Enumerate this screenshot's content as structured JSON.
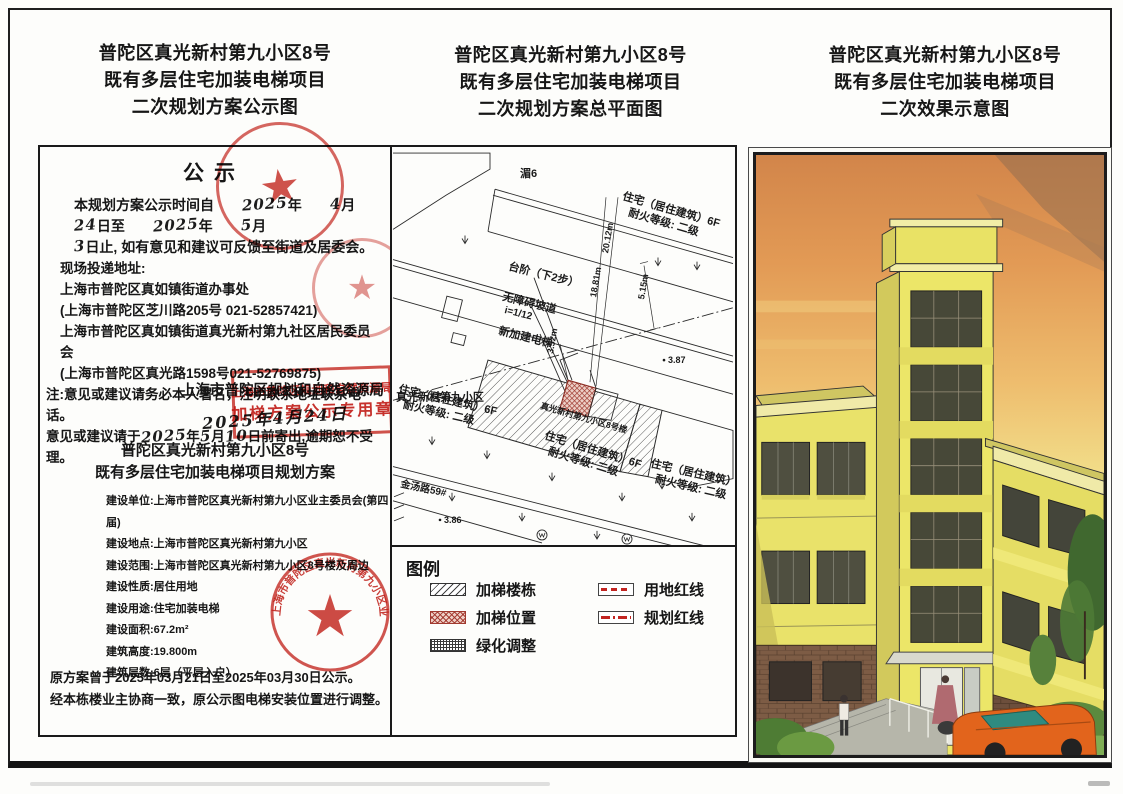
{
  "titles": {
    "left": [
      "普陀区真光新村第九小区8号",
      "既有多层住宅加装电梯项目",
      "二次规划方案公示图"
    ],
    "middle": [
      "普陀区真光新村第九小区8号",
      "既有多层住宅加装电梯项目",
      "二次规划方案总平面图"
    ],
    "right": [
      "普陀区真光新村第九小区8号",
      "既有多层住宅加装电梯项目",
      "二次效果示意图"
    ]
  },
  "notice": {
    "heading": "公示",
    "p1a": "本规划方案公示时间自",
    "hand_y1": "2025",
    "t_year1": "年",
    "hand_m1": "4",
    "t_month1": "月",
    "hand_d1": "24",
    "t_to": "日至",
    "hand_y2": "2025",
    "t_year2": "年",
    "hand_m2": "5",
    "t_month2": "月",
    "hand_d2": "3",
    "p1b": "日止, 如有意见和建议可反馈至街道及居委会。",
    "addr_label": "现场投递地址:",
    "addr1": "上海市普陀区真如镇街道办事处",
    "addr1_detail": "(上海市普陀区芝川路205号 021-52857421)",
    "addr2": "上海市普陀区真如镇街道真光新村第九社区居民委员会",
    "addr2_detail": "(上海市普陀区真光路1598号021-52769875)",
    "note1": "注:意见或建议请务必本人署名，注明联系地址联系电话。",
    "note2a": "意见或建议请于",
    "hand_n1": "2025",
    "note2b": "年",
    "hand_n2": "5",
    "note2c": "月",
    "hand_n3": "10",
    "note2d": "日前寄出,逾期恕不受理。",
    "authority": "上海市普陀区规划和自然资源局",
    "authority_date": "2025年4月24日",
    "stamp_rect_line1": "上海市普陀区规划和自然资源局",
    "stamp_rect_line2": "加梯方案公示专用章",
    "sub1": "普陀区真光新村第九小区8号",
    "sub2": "既有多层住宅加装电梯项目规划方案",
    "details": [
      "建设单位:上海市普陀区真光新村第九小区业主委员会(第四届)",
      "建设地点:上海市普陀区真光新村第九小区",
      "建设范围:上海市普陀区真光新村第九小区8号楼及周边",
      "建设性质:居住用地",
      "建设用途:住宅加装电梯",
      "建设面积:67.2m²",
      "建筑高度:19.800m",
      "建筑层数:6层（平层入户）"
    ],
    "footer1": "原方案曾于2025年03月21日至2025年03月30日公示。",
    "footer2": "经本栋楼业主协商一致，原公示图电梯安装位置进行调整。",
    "owner_stamp_text": "上海市普陀区真光新村第九小区业主委员会(第四届)",
    "star": "★"
  },
  "plan": {
    "labels": {
      "river": "湄6",
      "res1": "住宅（居住建筑）6F",
      "res2": "耐火等级: 二级",
      "community": "真光新村第九小区",
      "steps": "台阶（下2步）",
      "ramp1": "无障碍坡道",
      "ramp2": "i=1/12",
      "new_elevator": "新加建电梯",
      "building8": "真光新村第九小区8号楼",
      "dim_2012": "20.12m",
      "dim_1881": "18.81m",
      "dim_515": "5.15m",
      "dim_352": "3.52m",
      "spot_387": "3.87",
      "spot_386": "3.86",
      "road": "金汤路59#"
    },
    "legend": {
      "title": "图例",
      "items": [
        "加梯楼栋",
        "加梯位置",
        "绿化调整",
        "用地红线",
        "规划红线"
      ]
    }
  },
  "colors": {
    "stamp_red": "#c23227",
    "building_yellow": "#ece668",
    "sky_orange": "#dd8f4e",
    "brick_brown": "#7d5c45",
    "car_orange": "#e2641c"
  }
}
